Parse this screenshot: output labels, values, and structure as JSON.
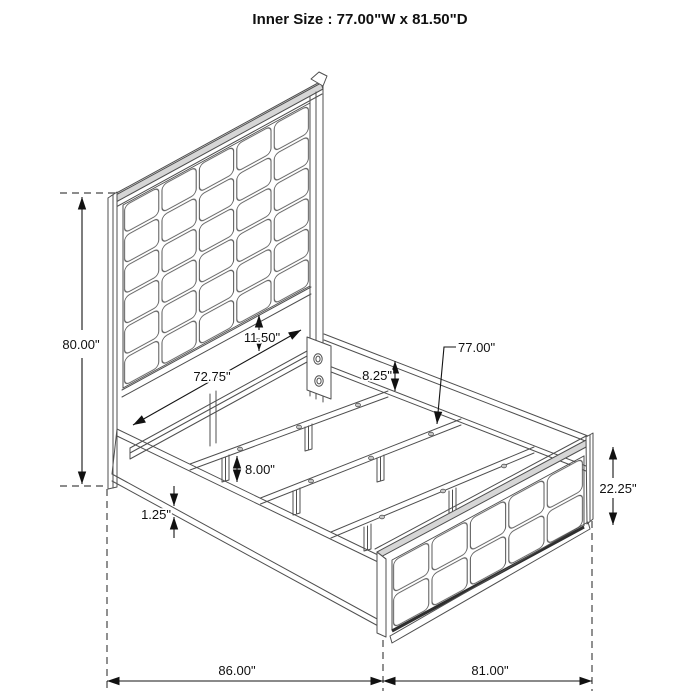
{
  "title": "Inner Size : 77.00\"W x 81.50\"D",
  "dimensions": {
    "overall_height": "80.00\"",
    "headboard_panel_width": "72.75\"",
    "panel_to_rail_gap": "11.50\"",
    "side_rail_depth": "8.25\"",
    "slat_length": "77.00\"",
    "support_leg_height": "8.00\"",
    "base_rail_lip": "1.25\"",
    "footboard_height": "22.25\"",
    "overall_length": "86.00\"",
    "overall_width": "81.00\""
  }
}
